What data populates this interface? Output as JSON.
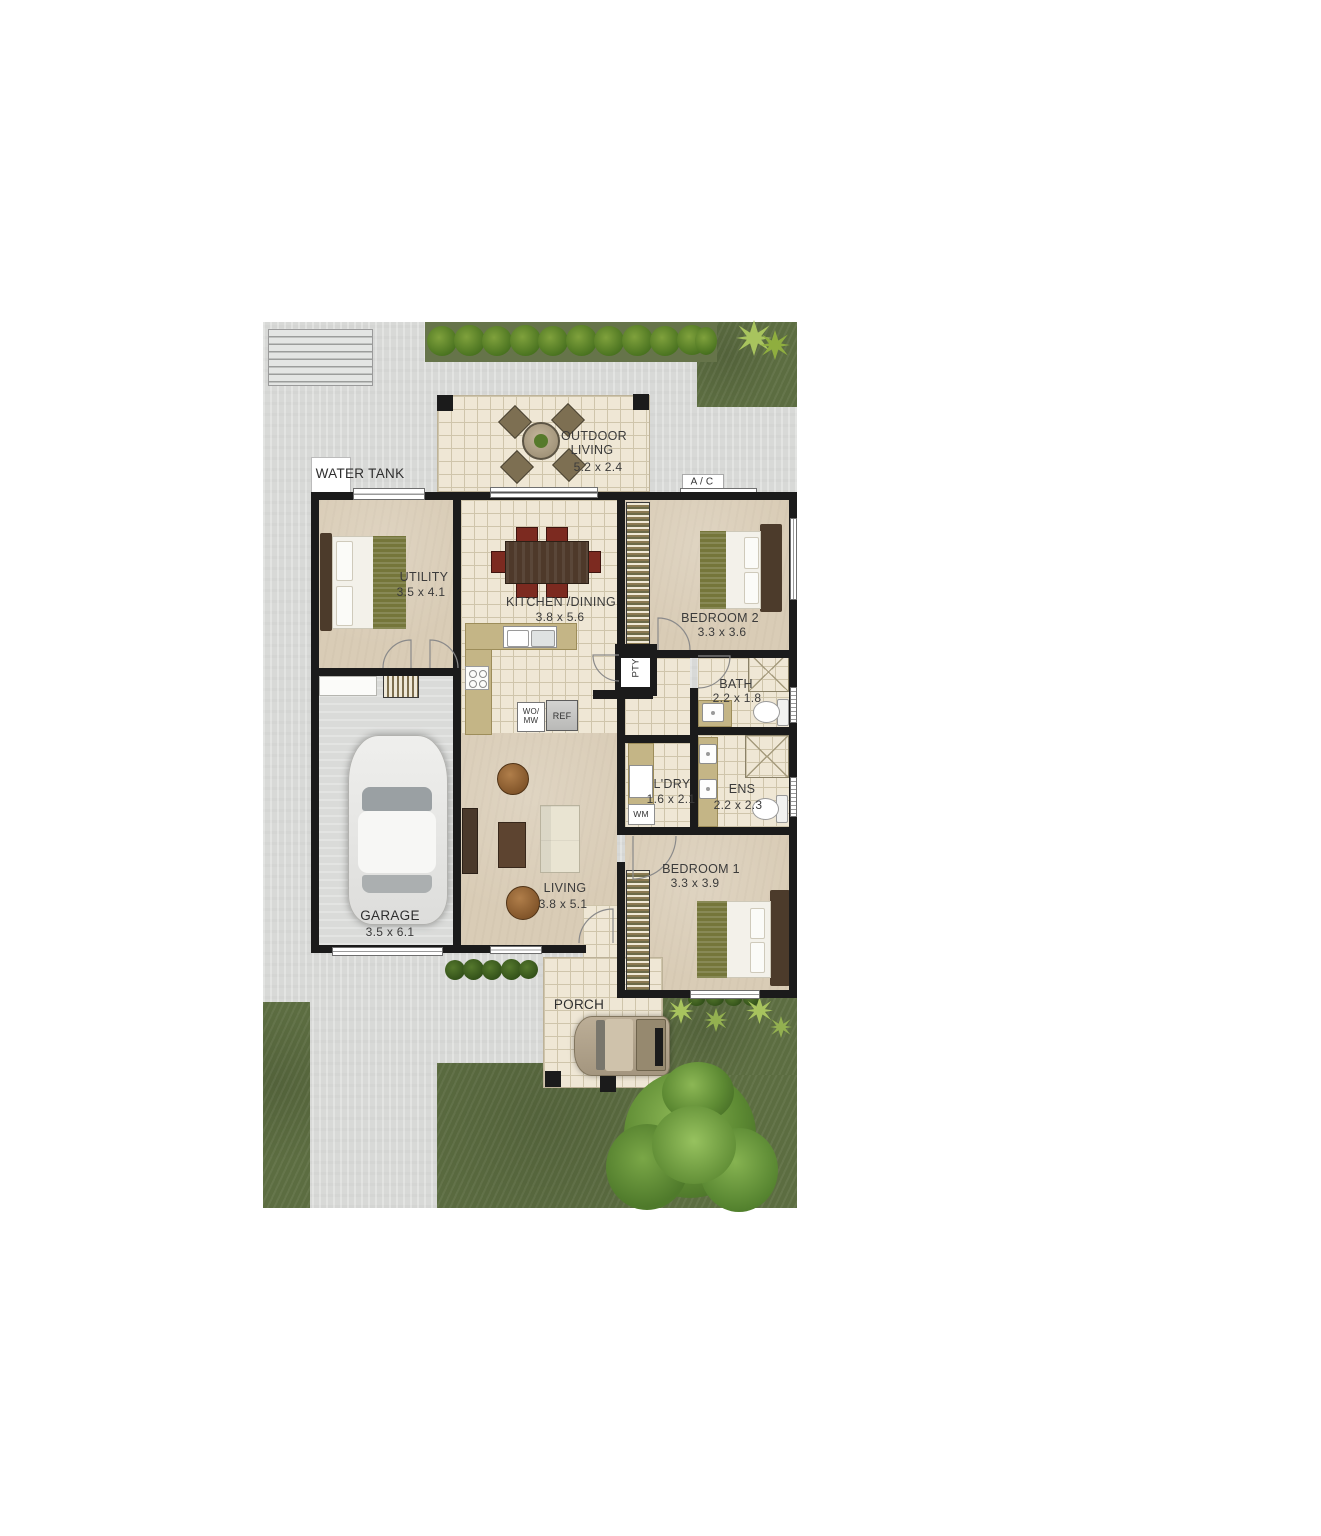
{
  "site": {
    "water_tank_label": "WATER TANK",
    "ac_label": "A / C"
  },
  "rooms": {
    "outdoor_living": {
      "line1": "OUTDOOR",
      "line2": "LIVING",
      "dims": "5.2 x 2.4"
    },
    "utility": {
      "name": "UTILITY",
      "dims": "3.5 x 4.1"
    },
    "kitchen_dining": {
      "name": "KITCHEN /DINING",
      "dims": "3.8 x 5.6"
    },
    "bedroom2": {
      "name": "BEDROOM 2",
      "dims": "3.3 x 3.6"
    },
    "bath": {
      "name": "BATH",
      "dims": "2.2 x 1.8"
    },
    "laundry": {
      "name": "L'DRY",
      "dims": "1.6 x 2.1"
    },
    "ensuite": {
      "name": "ENS",
      "dims": "2.2 x 2.3"
    },
    "garage": {
      "name": "GARAGE",
      "dims": "3.5 x 6.1"
    },
    "living": {
      "name": "LIVING",
      "dims": "3.8 x 5.1"
    },
    "bedroom1": {
      "name": "BEDROOM 1",
      "dims": "3.3 x 3.9"
    },
    "porch": {
      "name": "PORCH"
    }
  },
  "fixtures": {
    "pantry": "PTY",
    "fridge": "REF",
    "wall_oven_line1": "WO/",
    "wall_oven_line2": "MW",
    "washing_machine": "WM"
  },
  "colors": {
    "wall": "#1b1b1b",
    "tile": "#efe7d5",
    "carpet": "#d9ccb6",
    "paving": "#d8d9d7",
    "grass": "#5c6d41",
    "bench": "#c4b586",
    "accent_olive": "#75763a",
    "accent_wood": "#4c3b2b"
  }
}
